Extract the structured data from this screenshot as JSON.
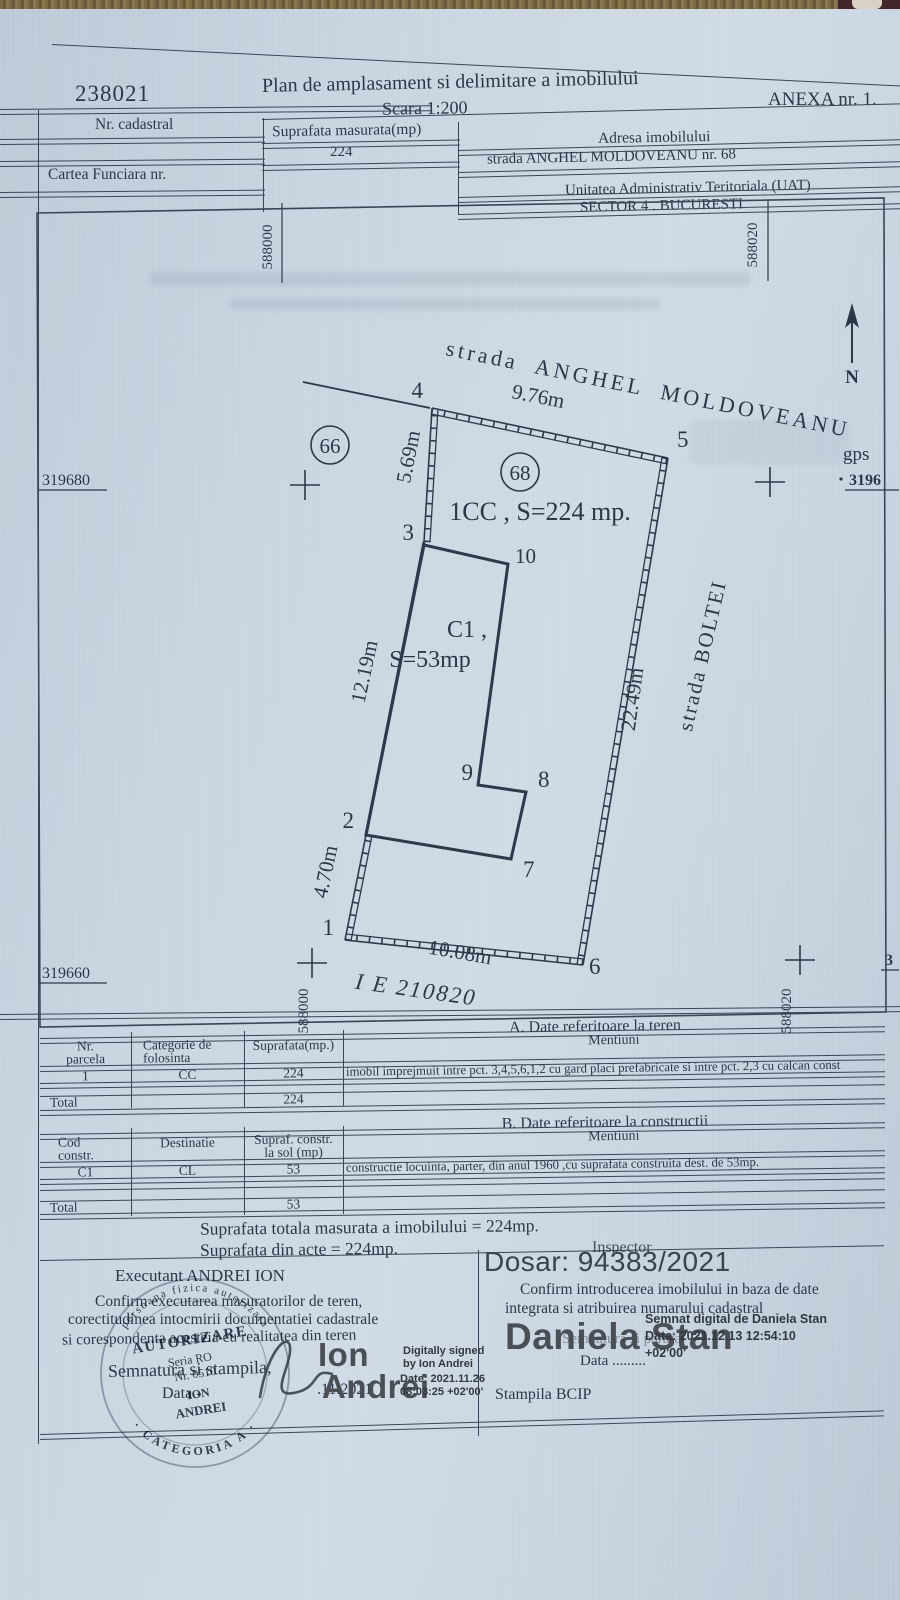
{
  "header": {
    "cadastral_number": "238021",
    "title": "Plan de amplasament si delimitare a imobilului",
    "scale": "Scara 1:200",
    "annex": "ANEXA nr. 1.",
    "nr_cadastral_label": "Nr. cadastral",
    "suprafata_label": "Suprafata masurata(mp)",
    "suprafata_value": "224",
    "adresa_label": "Adresa imobilului",
    "adresa_value": "strada ANGHEL  MOLDOVEANU   nr. 68",
    "cartea_funciara_label": "Cartea Funciara nr.",
    "uat_label": "Unitatea Administrativ Teritoriala (UAT)",
    "uat_value": "SECTOR 4 . BUCURESTI"
  },
  "plan": {
    "street_top": "strada ANGHEL MOLDOVEANU",
    "street_right": "strada BOLTEI",
    "north": "N",
    "gps_label": "gps",
    "gps_value": "3196",
    "parcel_text": "1CC , S=224 mp.",
    "building_line1": "C1 ,",
    "building_line2": "S=53mp",
    "ie_text": "I E  210820",
    "neighbor_left": "66",
    "neighbor_right": "68",
    "points": {
      "p1": "1",
      "p2": "2",
      "p3": "3",
      "p4": "4",
      "p5": "5",
      "p6": "6",
      "p7": "7",
      "p8": "8",
      "p9": "9",
      "p10": "10"
    },
    "dims": {
      "top": "9.76m",
      "left_upper": "5.69m",
      "left_mid": "12.19m",
      "left_lower": "4.70m",
      "bottom": "10.08m",
      "right": "22.49m"
    },
    "grid": {
      "e1": "588000",
      "e2": "588020",
      "n1": "319680",
      "n2": "319660",
      "n_right": "3"
    }
  },
  "table_a": {
    "caption": "A. Date referitoare la teren",
    "h1": "Nr.\nparcela",
    "h2": "Categorie de\nfolosinta",
    "h3": "Suprafata(mp.)",
    "h4": "Mentiuni",
    "r1": [
      "1",
      "CC",
      "224",
      "imobil imprejmuit intre pct. 3,4,5,6,1,2  cu gard placi prefabricate si intre pct. 2,3 cu calcan const"
    ],
    "total_label": "Total",
    "total_value": "224"
  },
  "table_b": {
    "caption": "B. Date referitoare la constructii",
    "h1": "Cod\nconstr.",
    "h2": "Destinatie",
    "h3": "Supraf. constr.\nla sol (mp)",
    "h4": "Mentiuni",
    "r1": [
      "C1",
      "CL",
      "53",
      "constructie locuinta, parter, din anul 1960 ,cu suprafata construita dest.  de 53mp."
    ],
    "total_label": "Total",
    "total_value": "53"
  },
  "totals": {
    "line1": "Suprafata totala masurata a imobilului = 224mp.",
    "line2": "Suprafata din acte = 224mp."
  },
  "sig_left": {
    "executant": "Executant ANDREI ION",
    "confirm1": "Confirm executarea masuratorilor de teren,",
    "confirm2": "corectitudinea intocmirii documentatiei cadastrale",
    "confirm3": "si corespondenta acesteia cu realitatea din teren",
    "semnatura": "Semnatura si stampila,",
    "data_label": "Data -",
    "data_value": ".11.2021",
    "dig1": "Ion",
    "dig2": "Andrei",
    "info1": "Digitally signed",
    "info2": "by Ion Andrei",
    "info3": "Date: 2021.11.26",
    "info4": "08:03:25 +02'00'"
  },
  "sig_right": {
    "inspector": "Inspector",
    "dosar": "Dosar: 94383/2021",
    "confirm1": "Confirm introducerea  imobilului in baza de date",
    "confirm2": "integrata si atribuirea numarului cadastral",
    "dig": "Daniela Stan",
    "overlap": "Semnatura si parafa",
    "info1": "Semnat digital de Daniela Stan",
    "info2": "Data: 2021.12.13 12:54:10",
    "info3": "+02'00'",
    "data_label": "Data .........",
    "stampila": "Stampila BCIP"
  },
  "stamp": {
    "ring_top": "persoana fizica autorizata",
    "ring_bottom": "· CATEGORIA A ·",
    "l1": "AUTORIZARE",
    "l2": "Seria RO",
    "l3": "Nr. 0510",
    "l4": "ION",
    "l5": "ANDREI"
  }
}
